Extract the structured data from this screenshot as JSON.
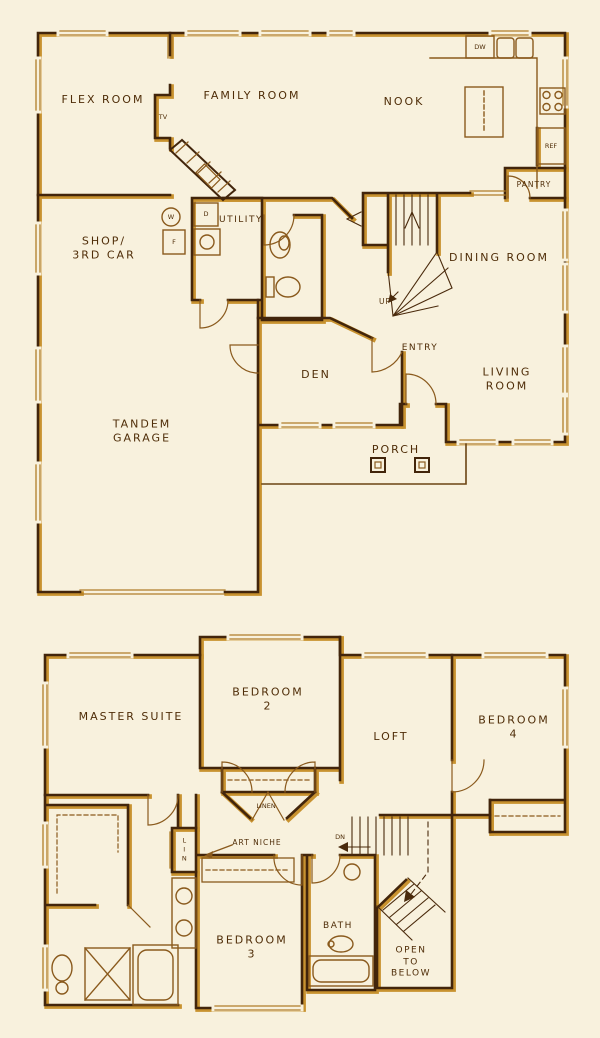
{
  "colors": {
    "paper": "#f8f1dd",
    "ink": "#42250b",
    "gold_shadow": "#c8922f",
    "line_gold": "#8a5a1d",
    "label_ink": "#4f2d08"
  },
  "floor1": {
    "labels": {
      "flex_room": "FLEX ROOM",
      "tv": "TV",
      "family_room": "FAMILY ROOM",
      "nook": "NOOK",
      "dw": "DW",
      "ref": "REF",
      "pantry": "PANTRY",
      "dining_room": "DINING ROOM",
      "up": "UP",
      "shop_3rd_car": "SHOP/\n3RD CAR",
      "utility": "UTILITY",
      "water_heater": "W",
      "furnace": "F",
      "dryer": "D",
      "den": "DEN",
      "entry": "ENTRY",
      "living_room": "LIVING ROOM",
      "porch": "PORCH",
      "tandem_garage": "TANDEM\nGARAGE"
    }
  },
  "floor2": {
    "labels": {
      "master_suite": "MASTER SUITE",
      "bedroom_2": "BEDROOM\n2",
      "linen": "LINEN",
      "loft": "LOFT",
      "bedroom_4": "BEDROOM\n4",
      "dn": "DN",
      "art_niche": "ART NICHE",
      "lin": "LIN",
      "bedroom_3": "BEDROOM\n3",
      "bath": "BATH",
      "open_to_below": "OPEN\nTO\nBELOW"
    }
  }
}
